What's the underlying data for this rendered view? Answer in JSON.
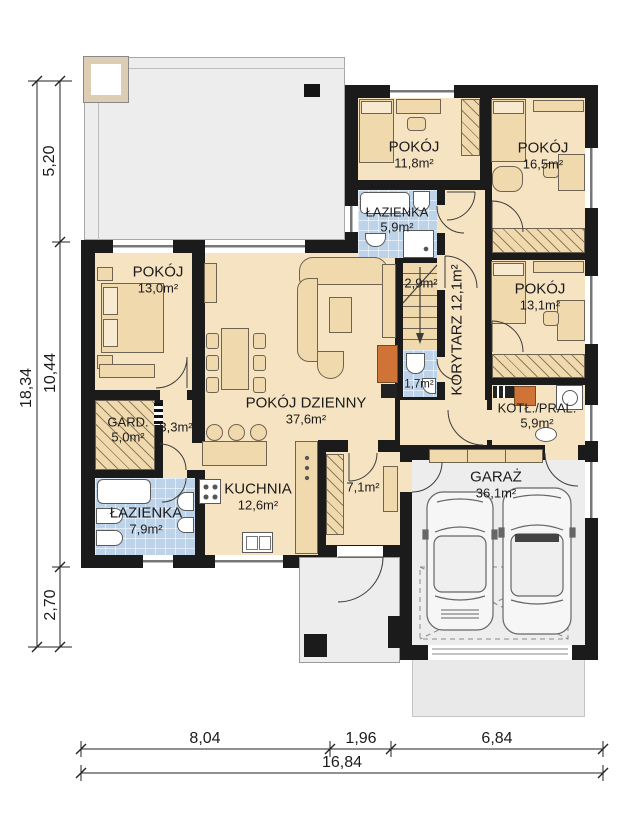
{
  "plan_title": "parter-floor-plan",
  "rooms": {
    "pokoj_13_0": {
      "name": "POKÓJ",
      "area": "13,0m²"
    },
    "pokoj_dzienny": {
      "name": "POKÓJ DZIENNY",
      "area": "37,6m²"
    },
    "kuchnia": {
      "name": "KUCHNIA",
      "area": "12,6m²"
    },
    "lazienka_7_9": {
      "name": "ŁAZIENKA",
      "area": "7,9m²"
    },
    "garderoba": {
      "name": "GARD.",
      "area": "5,0m²"
    },
    "hol": {
      "area": "3,3m²"
    },
    "pokoj_11_8": {
      "name": "POKÓJ",
      "area": "11,8m²"
    },
    "lazienka_5_9": {
      "name": "ŁAZIENKA",
      "area": "5,9m²"
    },
    "schody": {
      "area": "2,9m²"
    },
    "korytarz": {
      "label": "KORYTARZ 12,1m²"
    },
    "wc": {
      "area": "1,7m²"
    },
    "pokoj_16_5": {
      "name": "POKÓJ",
      "area": "16,5m²"
    },
    "pokoj_13_1": {
      "name": "POKÓJ",
      "area": "13,1m²"
    },
    "kotlownia": {
      "name": "KOTŁ./PRAL.",
      "area": "5,9m²"
    },
    "wiatrolap": {
      "area": "7,1m²"
    },
    "garaz": {
      "name": "GARAŻ",
      "area": "36,1m²"
    }
  },
  "dimensions": {
    "left_total": "18,34",
    "left_top": "5,20",
    "left_mid": "10,44",
    "left_bottom": "2,70",
    "bottom_left": "8,04",
    "bottom_mid": "1,96",
    "bottom_right": "6,84",
    "bottom_total": "16,84"
  },
  "colors": {
    "wall": "#1b1b1b",
    "floor": "#f6e3c2",
    "furn": "#f0d9ad",
    "blue": "#bdd3e9",
    "gray": "#ededed",
    "orange": "#cf7436",
    "line": "#3c3c3c"
  }
}
